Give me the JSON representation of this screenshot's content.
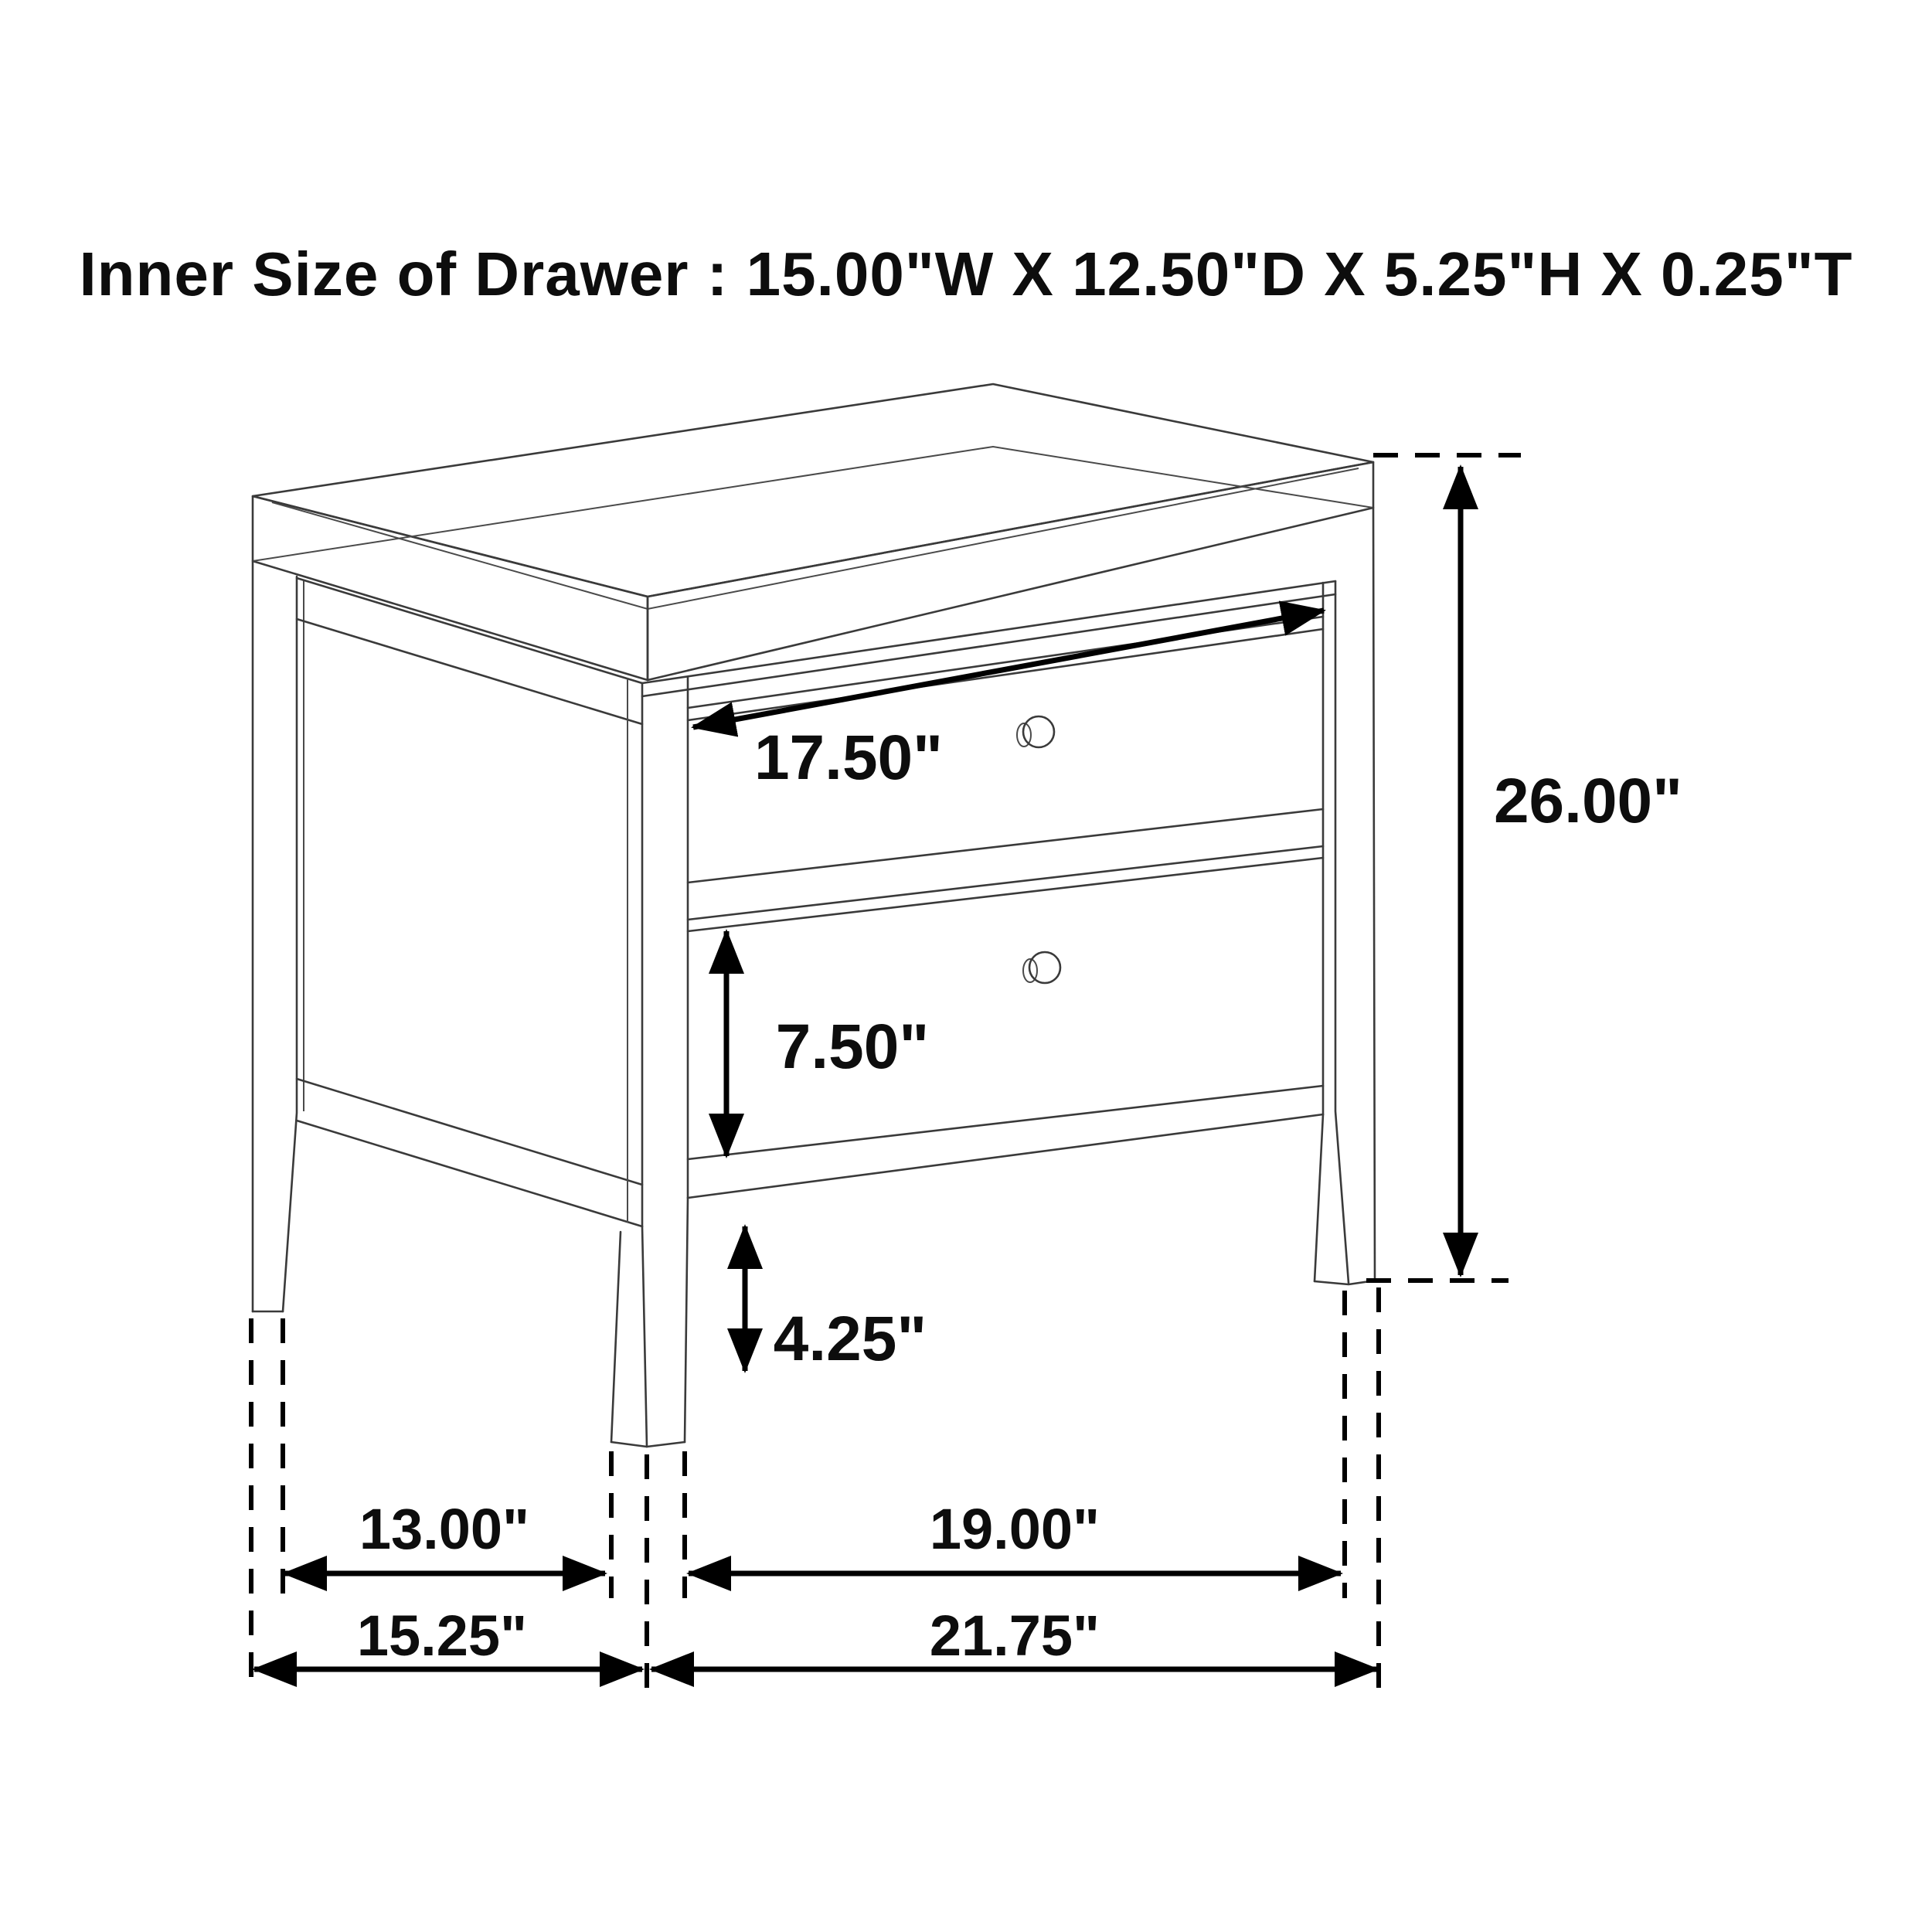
{
  "title": "Inner Size of Drawer : 15.00\"W X 12.50\"D X 5.25\"H X 0.25\"T",
  "drawing": {
    "subject": "two-drawer nightstand line drawing with dimension annotations",
    "dimensions": {
      "drawer_front_width": "17.50\"",
      "overall_height": "26.00\"",
      "bottom_drawer_height": "7.50\"",
      "floor_clearance": "4.25\"",
      "side_inner_depth": "13.00\"",
      "front_inner_width": "19.00\"",
      "side_overall_depth": "15.25\"",
      "front_overall_width": "21.75\""
    },
    "inner_drawer_size": {
      "width": "15.00\"",
      "depth": "12.50\"",
      "height": "5.25\"",
      "thickness": "0.25\""
    }
  }
}
